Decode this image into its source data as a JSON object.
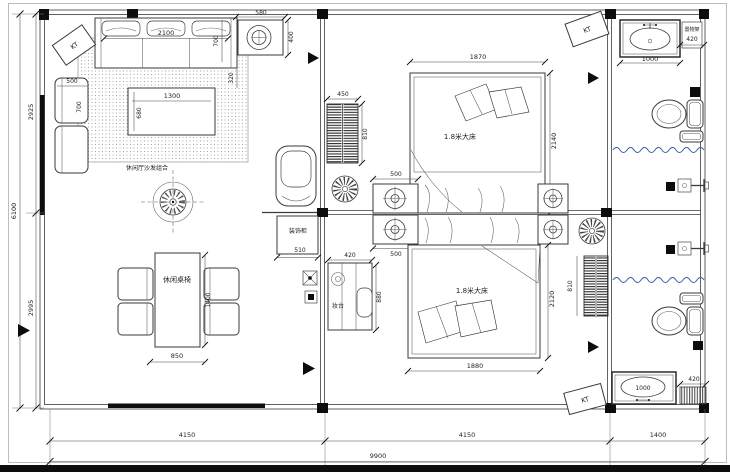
{
  "plan": {
    "unit_labels": {
      "kt": "KT"
    },
    "rooms": {
      "living_sofa": "休闲厅沙发组合",
      "living_table": "休闲桌椅",
      "bed1": "1.8米大床",
      "bed2": "1.8米大床",
      "dresser": "妆台",
      "cabinet": "装饰柜",
      "shelf": "置物架"
    },
    "dims": {
      "total_w": "9900",
      "left_span": "4150",
      "mid_span": "4150",
      "right_span": "1400",
      "total_h": "6100",
      "upper_h": "2925",
      "lower_h": "2995",
      "sofa_w": "2100",
      "sofa_d": "700",
      "sofa_edge": "320",
      "vent_w": "580",
      "vent_h": "400",
      "chair_w": "500",
      "chair_d": "700",
      "ctable_w": "1300",
      "ctable_d": "680",
      "ltable_w": "850",
      "ltable_l": "1400",
      "rad_w": "450",
      "rad_h": "810",
      "rad2_h": "810",
      "bed1_w": "1870",
      "bed1_l": "2140",
      "bed2_w": "1880",
      "bed2_l": "2120",
      "ns1_w": "500",
      "ns2_w": "500",
      "cab_w": "510",
      "dresser_w": "420",
      "dresser_l": "880",
      "sink1_w": "1000",
      "sink2_w": "1000",
      "shelf1_w": "420",
      "shelf2_w": "420"
    }
  }
}
